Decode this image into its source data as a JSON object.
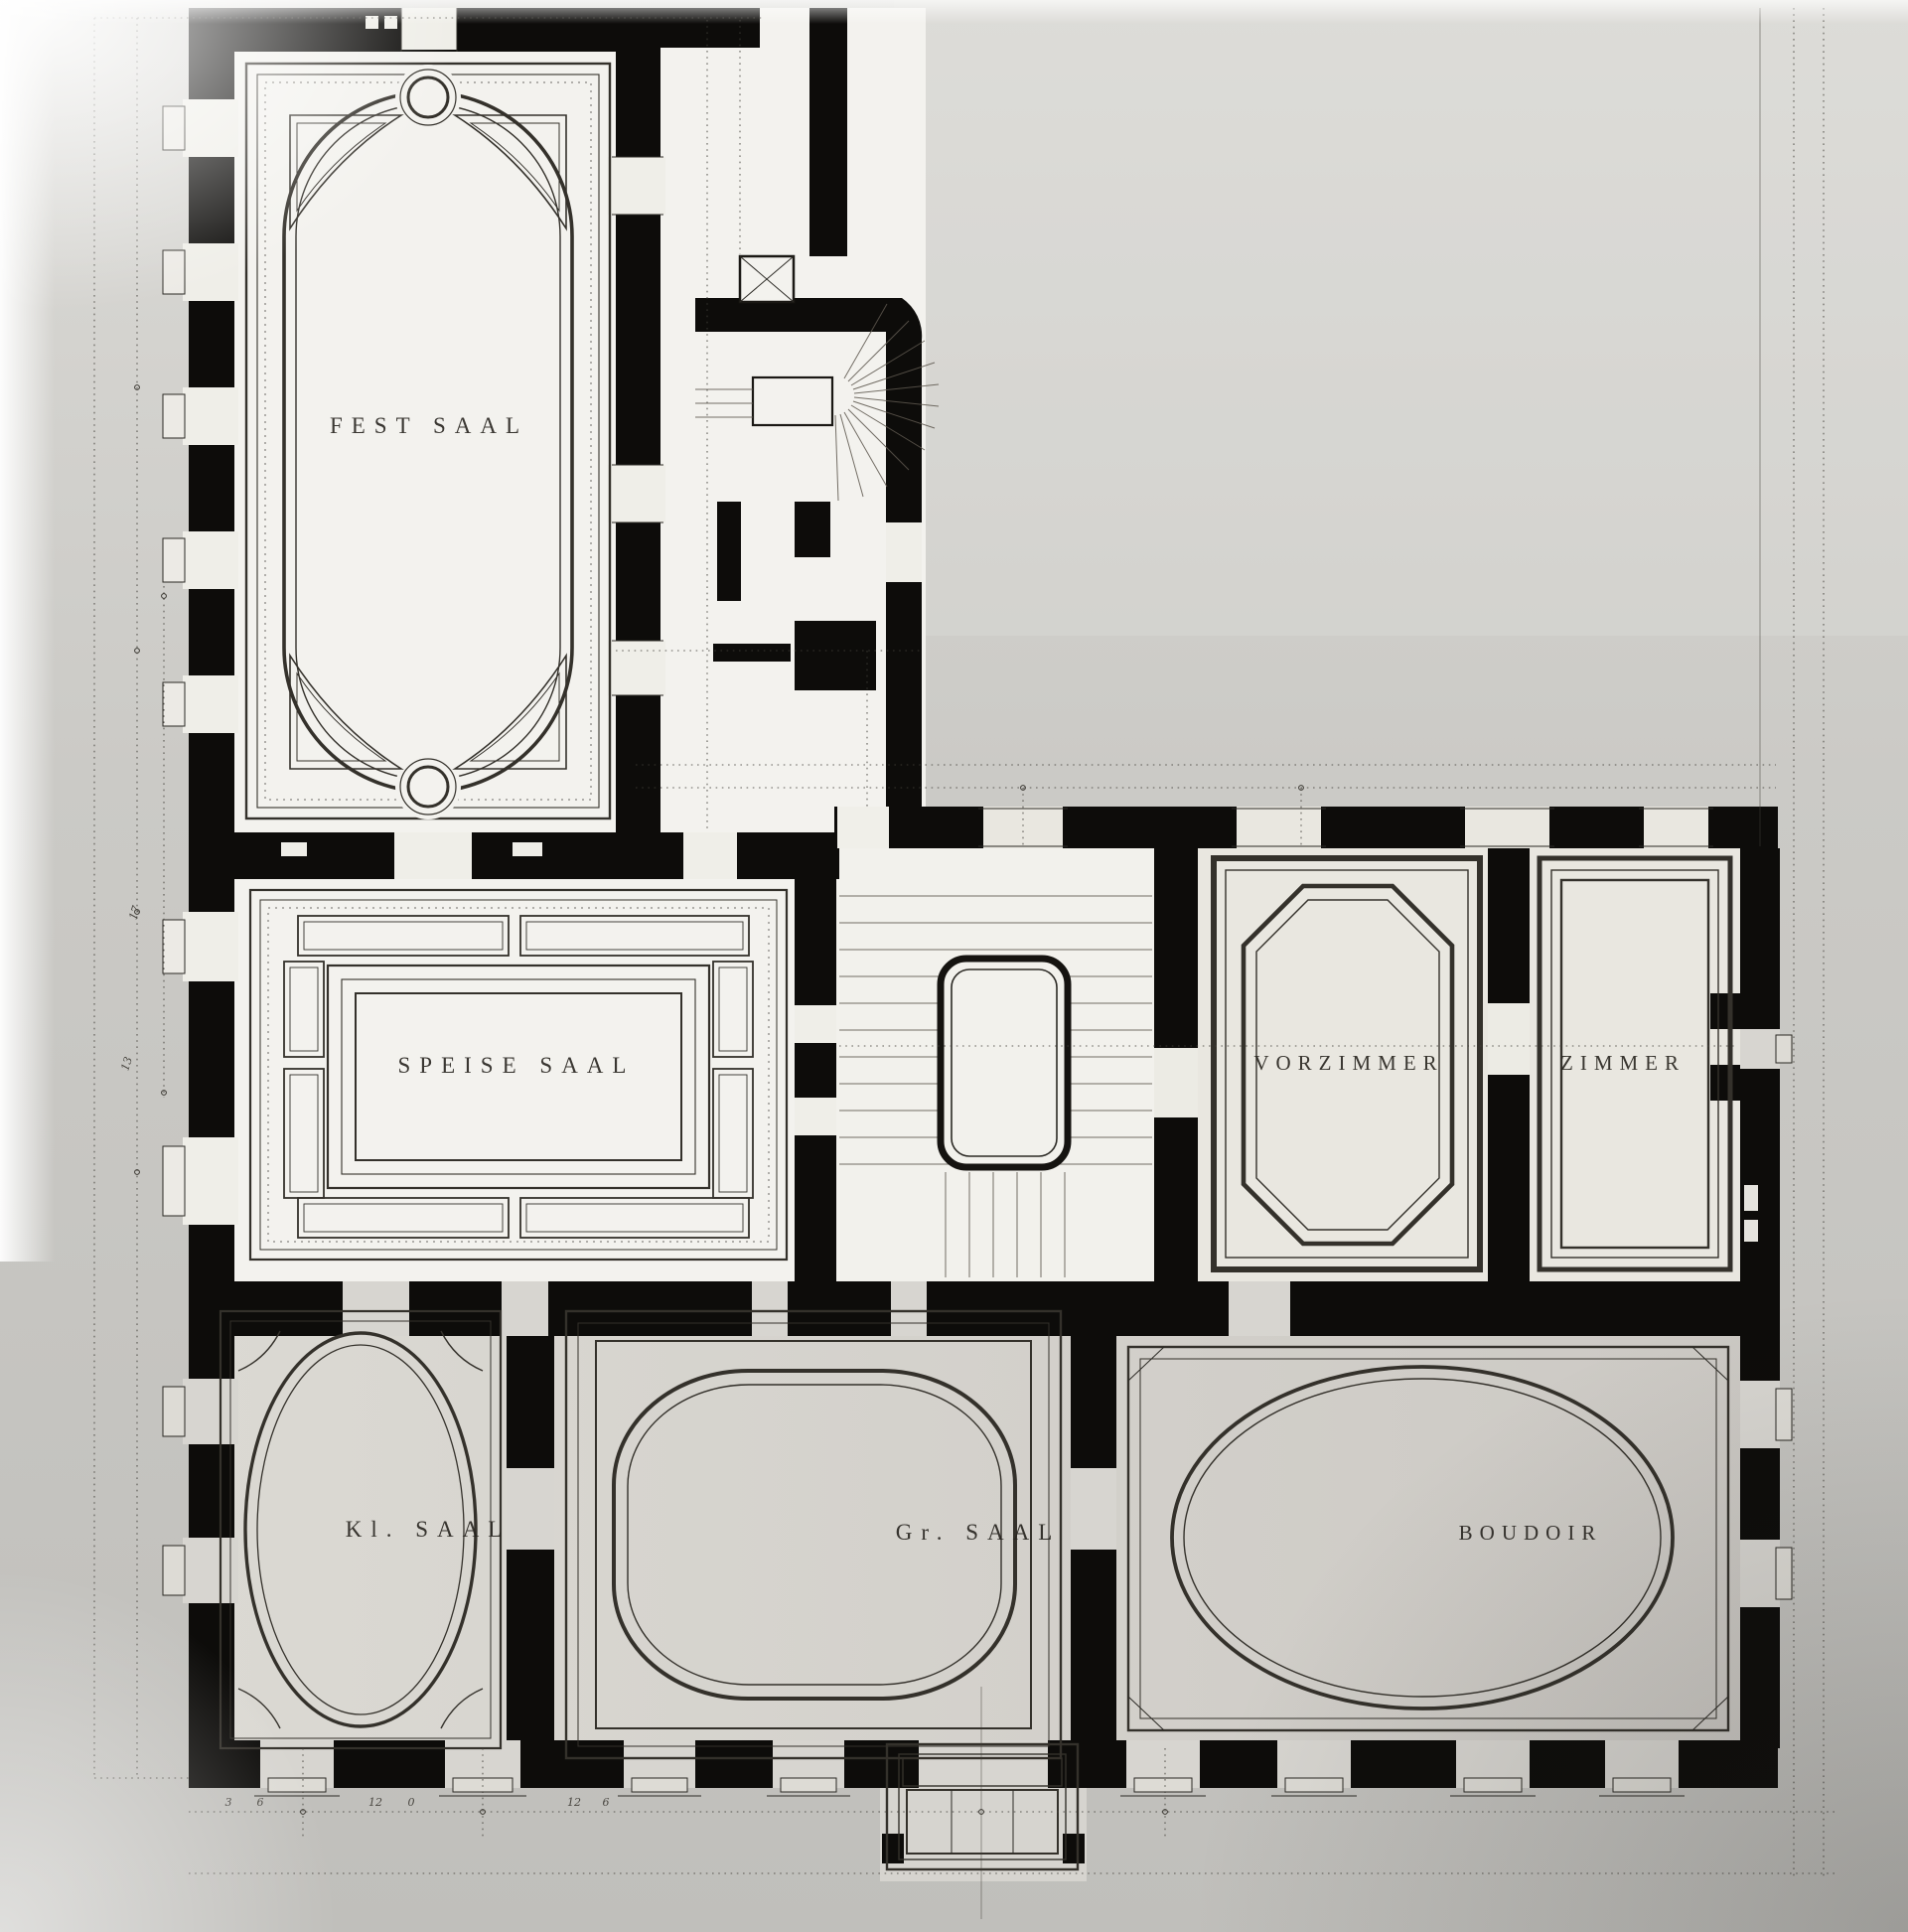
{
  "document": {
    "kind": "scanned architectural floor plan",
    "language": "German",
    "style": "ink on gray paper, black poché walls, dotted dimension chains"
  },
  "palette": {
    "paper": "#cbcac6",
    "wall_ink": "#0d0c0a",
    "line_ink": "#34312b",
    "room_fill_light": "#f3f2ee",
    "room_fill_shaded": "#d6d4cf"
  },
  "rooms": [
    {
      "id": "fest-saal",
      "label": "FEST SAAL"
    },
    {
      "id": "speise-saal",
      "label": "SPEISE SAAL"
    },
    {
      "id": "vorzimmer",
      "label": "VORZIMMER"
    },
    {
      "id": "zimmer",
      "label": "ZIMMER"
    },
    {
      "id": "kl-saal",
      "label": "Kl. SAAL"
    },
    {
      "id": "gr-saal",
      "label": "Gr. SAAL"
    },
    {
      "id": "boudoir",
      "label": "BOUDOIR"
    }
  ],
  "features": {
    "grand_staircase": "central stair hall with rounded stairwell and straight flights",
    "service_staircase": "winder (fan) stair with shaft marked by cross bracing",
    "porch": "projecting entrance steps at bottom center"
  },
  "dimensions": {
    "left_chain": [
      "17",
      "13"
    ],
    "bottom_chain": [
      "3",
      "6",
      "12",
      "0",
      "12",
      "6"
    ]
  }
}
